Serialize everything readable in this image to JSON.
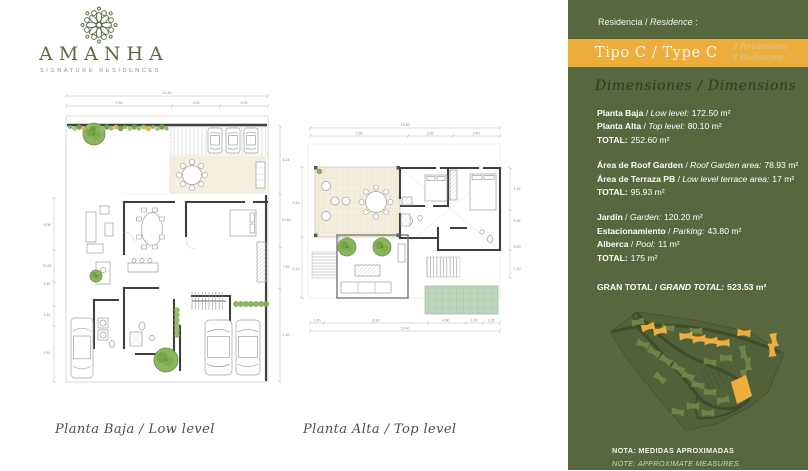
{
  "brand": {
    "name": "AMANHA",
    "tagline": "SIGNATURE RESIDENCES"
  },
  "panel": {
    "residence_es": "Residencia",
    "residence_sep": " / ",
    "residence_en": "Residence",
    "residence_colon": " :",
    "type_title": "Tipo C / Type C",
    "bedrooms_es": "3 Recámaras",
    "bedrooms_en": "3 Bedrooms",
    "dimensions_heading": "Dimensiones / Dimensions",
    "sep": " / ",
    "groups": [
      {
        "rows": [
          {
            "es": "Planta Baja",
            "en": "Low level:",
            "value": "172.50 m²"
          },
          {
            "es": "Planta Alta",
            "en": "Top level:",
            "value": "80.10 m²"
          }
        ],
        "total_label": "TOTAL:",
        "total_value": "252.60 m²"
      },
      {
        "rows": [
          {
            "es": "Área de Roof Garden",
            "en": "Roof Garden area:",
            "value": "78.93 m²"
          },
          {
            "es": "Área de Terraza PB",
            "en": "Low level terrace area:",
            "value": "17 m²"
          }
        ],
        "total_label": "TOTAL:",
        "total_value": "95.93 m²"
      },
      {
        "rows": [
          {
            "es": "Jardín",
            "en": "Garden:",
            "value": "120.20 m²"
          },
          {
            "es": "Estacionamiento",
            "en": "Parking:",
            "value": "43.80 m²"
          },
          {
            "es": "Alberca",
            "en": "Pool:",
            "value": "11 m²"
          }
        ],
        "total_label": "TOTAL:",
        "total_value": "175 m²"
      }
    ],
    "grand_total": {
      "es": "GRAN TOTAL",
      "en": "GRAND TOTAL:",
      "value": "523.53 m²"
    },
    "note_es": "NOTA: MEDIDAS APROXIMADAS",
    "note_en": "NOTE: APPROXIMATE MEASURES"
  },
  "plans": {
    "left": {
      "caption": "Planta Baja / Low level",
      "dims": {
        "total": "13.40",
        "segments": [
          "7.50",
          "3.20",
          "4.00"
        ],
        "left": [
          "5.08",
          "10.85",
          "3.40",
          "1.14",
          "2.51"
        ],
        "right": [
          "8.24",
          "10.48",
          "7.26",
          "1.40"
        ]
      }
    },
    "right": {
      "caption": "Planta Alta / Top level",
      "dims": {
        "total": "13.40",
        "segments": [
          "7.50",
          "3.95",
          "3.40"
        ],
        "bottom_total": "13.40",
        "bottom_segments": [
          "1.00",
          "8.10",
          "4.60",
          "1.20",
          "1.20"
        ],
        "left": [
          "9.45",
          "5.15"
        ],
        "right": [
          "4.15",
          "8.45",
          "5.00",
          "1.20"
        ]
      }
    }
  },
  "site_map": {
    "greens": [
      [
        40,
        22,
        -10
      ],
      [
        70,
        28,
        5
      ],
      [
        98,
        31,
        0
      ],
      [
        128,
        58,
        0
      ],
      [
        112,
        62,
        10
      ],
      [
        45,
        44,
        20
      ],
      [
        56,
        52,
        30
      ],
      [
        68,
        60,
        35
      ],
      [
        80,
        68,
        35
      ],
      [
        90,
        76,
        25
      ],
      [
        62,
        78,
        40
      ],
      [
        100,
        85,
        15
      ],
      [
        112,
        92,
        5
      ],
      [
        125,
        100,
        -10
      ],
      [
        95,
        106,
        0
      ],
      [
        80,
        112,
        10
      ],
      [
        110,
        113,
        0
      ],
      [
        145,
        52,
        80
      ],
      [
        150,
        64,
        85
      ],
      [
        146,
        76,
        80
      ]
    ],
    "oranges": [
      [
        50,
        27,
        -15
      ],
      [
        62,
        31,
        -10
      ],
      [
        88,
        36,
        -5
      ],
      [
        101,
        39,
        -5
      ],
      [
        113,
        41,
        -3
      ],
      [
        125,
        43,
        -3
      ],
      [
        146,
        33,
        5
      ],
      [
        176,
        40,
        80
      ],
      [
        174,
        50,
        85
      ]
    ],
    "orange_big": "133,82 148,75 154,96 139,104"
  },
  "colors": {
    "green_bg": "#57683f",
    "orange": "#eeae3d",
    "heading_dark": "#2e3b22",
    "bedrooms_text": "#d3cc9c",
    "map_building": "#6f8449",
    "map_road": "#3f4e29",
    "map_parcel": "#51613a",
    "plan_beige": "#f3eedd",
    "green_roof": "#bdd6be"
  }
}
